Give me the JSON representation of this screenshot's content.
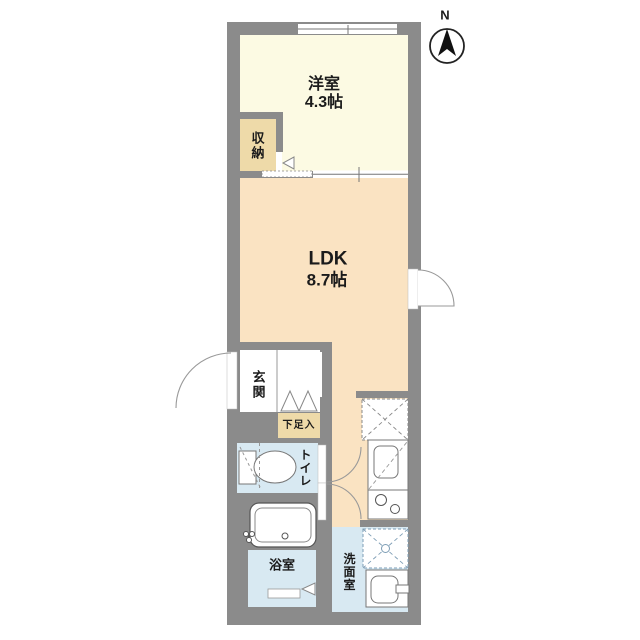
{
  "floor_plan": {
    "compass": {
      "label": "N"
    },
    "rooms": {
      "western_room": {
        "name": "洋室",
        "size": "4.3帖"
      },
      "closet": {
        "label": "収納"
      },
      "ldk": {
        "name": "LDK",
        "size": "8.7帖"
      },
      "entrance": {
        "label": "玄関"
      },
      "shoe_cabinet": {
        "label": "下足入"
      },
      "toilet": {
        "label": "トイレ"
      },
      "bathroom": {
        "label": "浴室"
      },
      "washroom": {
        "label": "洗面室"
      }
    },
    "colors": {
      "wall": "#8b8b8b",
      "western_room": "#fcfae3",
      "closet": "#eedaa9",
      "ldk": "#fae3c2",
      "wet_rooms": "#d8e9f2",
      "background": "#ffffff"
    },
    "fixtures": {
      "bathtub": "bathtub",
      "toilet_bowl": "toilet-bowl",
      "kitchen_sink": "kitchen-sink",
      "gas_stove": "gas-stove",
      "refrigerator_space": "refrigerator-space",
      "washing_machine_space": "washing-machine-space",
      "washbasin": "washbasin",
      "window": "window",
      "compass": "compass-north"
    }
  }
}
